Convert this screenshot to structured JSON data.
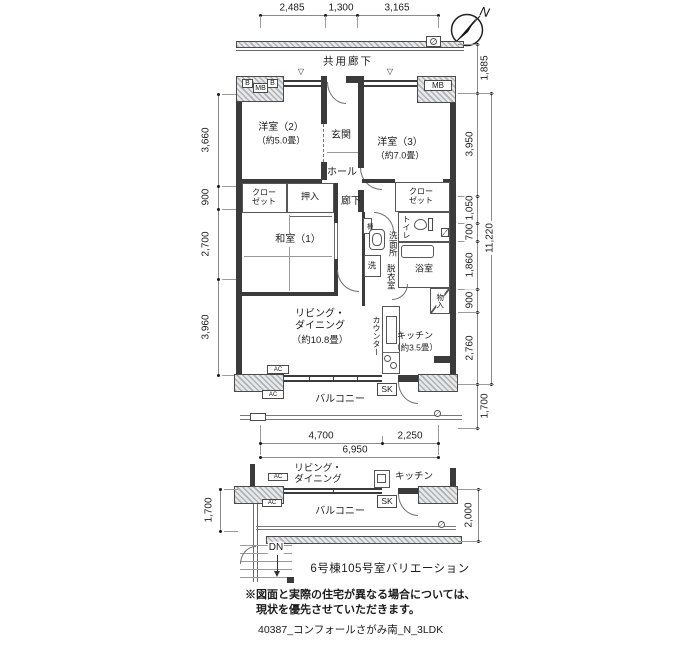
{
  "plan": {
    "compass_north": "N",
    "shared_corridor_label": "共用廊下",
    "window_marker": "▽"
  },
  "dims": {
    "top": [
      "2,485",
      "1,300",
      "3,165"
    ],
    "left": [
      "3,660",
      "900",
      "2,700",
      "3,960"
    ],
    "right": [
      "1,885",
      "3,950",
      "1,050",
      "700",
      "1,860",
      "900",
      "2,760",
      "1,700"
    ],
    "right_total": "11,220",
    "bottom_segments": [
      "4,700",
      "2,250"
    ],
    "bottom_total": "6,950",
    "sub_left": "1,700",
    "sub_right": "2,000"
  },
  "rooms": {
    "western2": "洋室（2）",
    "western2_size": "（約5.0畳）",
    "western3": "洋室（3）",
    "western3_size": "（約7.0畳）",
    "entrance": "玄関",
    "hall": "ホール",
    "corridor": "廊下",
    "japanese1": "和室（1）",
    "oshiire": "押入",
    "closet": "クローゼット",
    "shelf": "棚",
    "washroom": "洗面所",
    "toilet": "トイレ",
    "washer": "洗",
    "dressing_room": "脱衣室",
    "bathroom": "浴室",
    "storage": "物入",
    "living_dining": "リビング・ダイニング",
    "living_dining_size": "（約10.8畳）",
    "counter": "カウンター",
    "kitchen": "キッチン",
    "kitchen_size": "（約3.5畳）",
    "balcony": "バルコニー"
  },
  "fixtures": {
    "b_box": "B",
    "mb_box": "MB",
    "ac_unit": "AC",
    "sk_sink": "SK",
    "down_stairs": "DN"
  },
  "sub_plan": {
    "living_dining": "リビング・ダイニング",
    "kitchen": "キッチン",
    "balcony": "バルコニー"
  },
  "footer": {
    "caption": "6号棟105号室バリエーション",
    "note_line1": "※図面と実際の住宅が異なる場合については、",
    "note_line2": "現状を優先させていただきます。",
    "drawing_code": "40387_コンフォールさがみ南_N_3LDK"
  }
}
